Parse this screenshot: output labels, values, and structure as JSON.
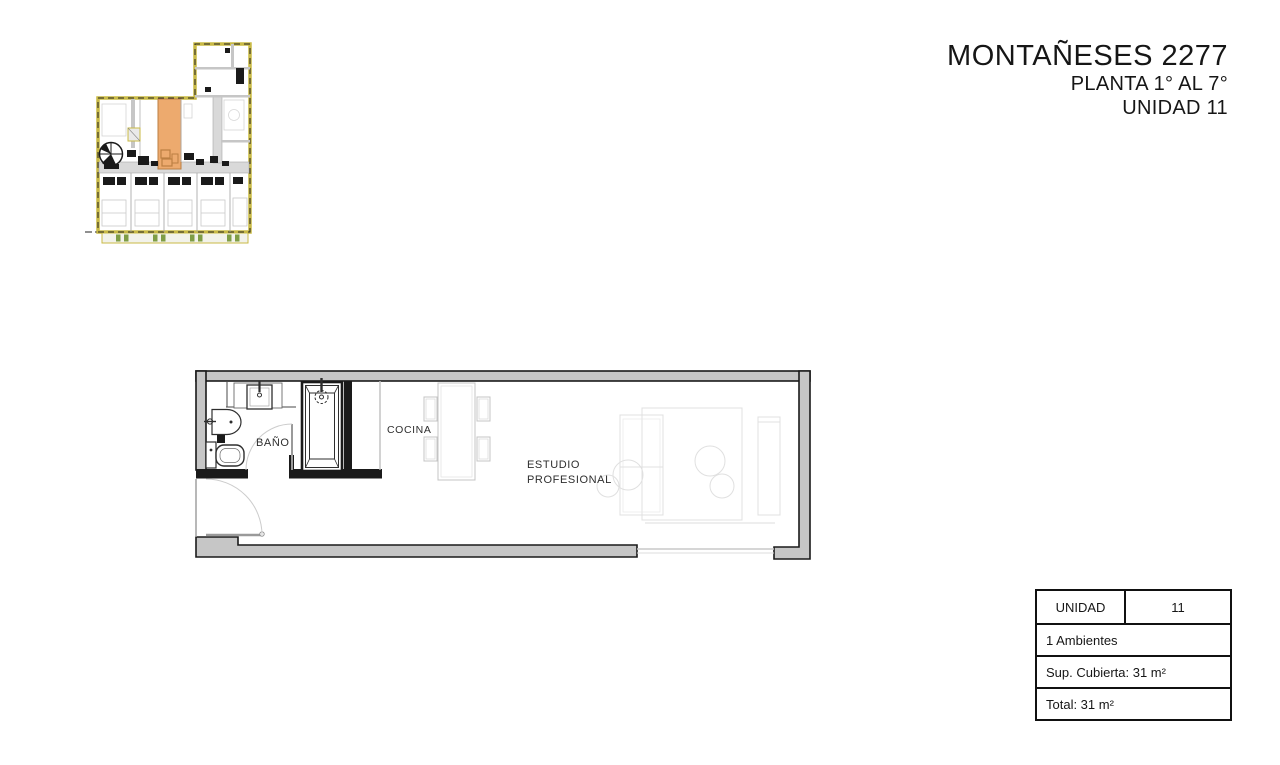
{
  "header": {
    "title": "MONTAÑESES 2277",
    "subtitle": "PLANTA 1° AL 7°",
    "unit_line": "UNIDAD 11"
  },
  "mini_plan": {
    "colors": {
      "boundary": "#c9ba45",
      "highlight": "#edaa6e",
      "highlight_detail": "#bc7f42",
      "planter": "#7f9d45",
      "wall": "#c6c6c6",
      "corridor": "#d9d9d9"
    }
  },
  "main_plan": {
    "labels": {
      "bathroom": "BAÑO",
      "kitchen": "COCINA",
      "studio_line1": "ESTUDIO",
      "studio_line2": "PROFESIONAL"
    }
  },
  "info_table": {
    "unit_label": "UNIDAD",
    "unit_number": "11",
    "rows": [
      "1 Ambientes",
      "Sup. Cubierta: 31 m²",
      "Total: 31 m²"
    ]
  }
}
